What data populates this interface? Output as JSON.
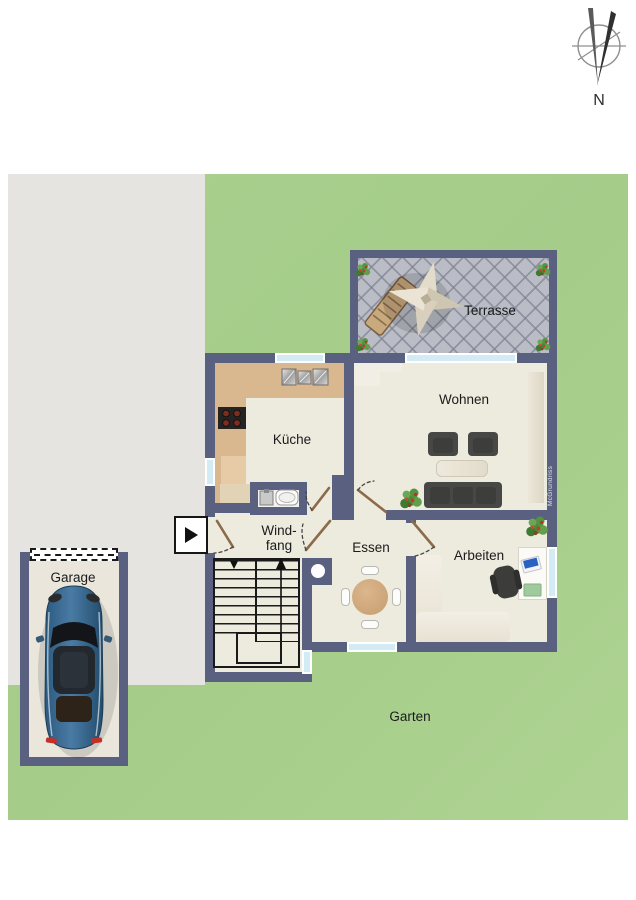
{
  "rooms": {
    "terrasse": {
      "label": "Terrasse"
    },
    "wohnen": {
      "label": "Wohnen"
    },
    "kueche": {
      "label": "Küche"
    },
    "windfang": {
      "line1": "Wind-",
      "line2": "fang"
    },
    "essen": {
      "label": "Essen"
    },
    "arbeiten": {
      "label": "Arbeiten"
    },
    "garage": {
      "label": "Garage"
    },
    "garten": {
      "label": "Garten"
    }
  },
  "compass": {
    "label": "N"
  },
  "watermark": {
    "text": "McGrundriss"
  },
  "colors": {
    "wall": "#5a6180",
    "floor": "#edeade",
    "grass": "#a8cf8d",
    "pavement": "#e5e4e1",
    "terrace_tile": "#babdc6",
    "window_glass": "#d2ebf5",
    "kitchen_counter": "#d9b78f",
    "furniture_dark": "#474745",
    "dining_table": "#cfa377",
    "car": "#36678f",
    "door_leaf": "#8b6b4a",
    "stair_line": "#1a1a1a"
  }
}
